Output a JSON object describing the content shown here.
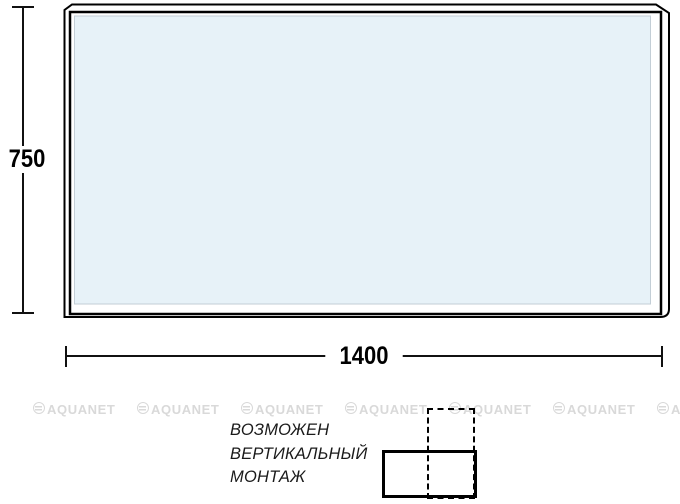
{
  "dimensions": {
    "height": "750",
    "width": "1400"
  },
  "note": {
    "lines": [
      "ВОЗМОЖЕН",
      "ВЕРТИКАЛЬНЫЙ",
      "МОНТАЖ"
    ]
  },
  "watermark": {
    "label": "AQUANET"
  },
  "colors": {
    "line": "#000000",
    "glass_fill": "#e7f2f8",
    "watermark": "#d9d9d9"
  }
}
